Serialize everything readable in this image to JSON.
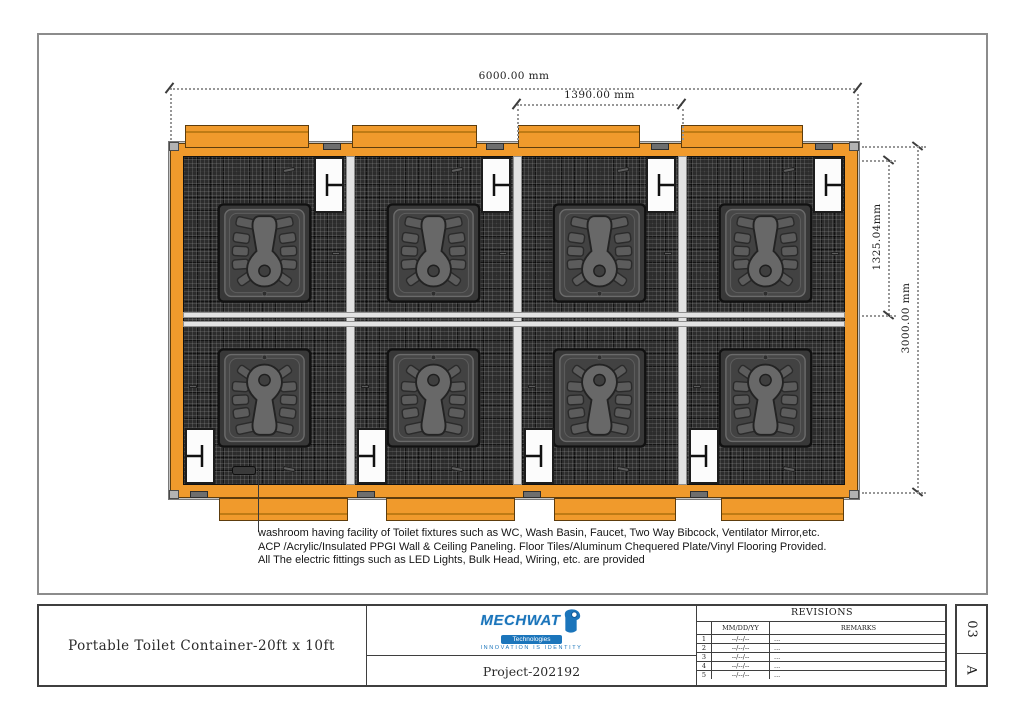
{
  "colors": {
    "container_orange": "#F09A2C",
    "container_stripe": "#BE7B15",
    "floor_dark": "#2C2C2C",
    "wall_light": "#E2E2E2",
    "logo_blue": "#1B75BB"
  },
  "plan": {
    "dim_width": "6000.00 mm",
    "dim_module": "1390.00 mm",
    "dim_partition": "1325.04mm",
    "dim_depth": "3000.00 mm",
    "annotation_lines": [
      "washroom having facility of Toilet fixtures such as WC, Wash Basin, Faucet, Two Way Bibcock, Ventilator Mirror,etc.",
      "ACP /Acrylic/Insulated PPGI Wall & Ceiling Paneling. Floor Tiles/Aluminum Chequered Plate/Vinyl Flooring Provided.",
      "All The electric fittings such as LED Lights, Bulk Head, Wiring, etc. are provided"
    ]
  },
  "title_block": {
    "drawing_title": "Portable Toilet Container-20ft x 10ft",
    "project_label": "Project-202192",
    "logo": {
      "brand": "MECHWAT",
      "division": "Technologies",
      "tagline": "INNOVATION IS IDENTITY"
    },
    "revisions": {
      "title": "REVISIONS",
      "col_date": "MM/DD/YY",
      "col_remarks": "REMARKS",
      "rows": [
        {
          "no": "1",
          "date": "--/--/--",
          "remark": "..."
        },
        {
          "no": "2",
          "date": "--/--/--",
          "remark": "..."
        },
        {
          "no": "3",
          "date": "--/--/--",
          "remark": "..."
        },
        {
          "no": "4",
          "date": "--/--/--",
          "remark": "..."
        },
        {
          "no": "5",
          "date": "--/--/--",
          "remark": "..."
        }
      ]
    },
    "sheet": {
      "number": "03",
      "rev": "A"
    }
  }
}
